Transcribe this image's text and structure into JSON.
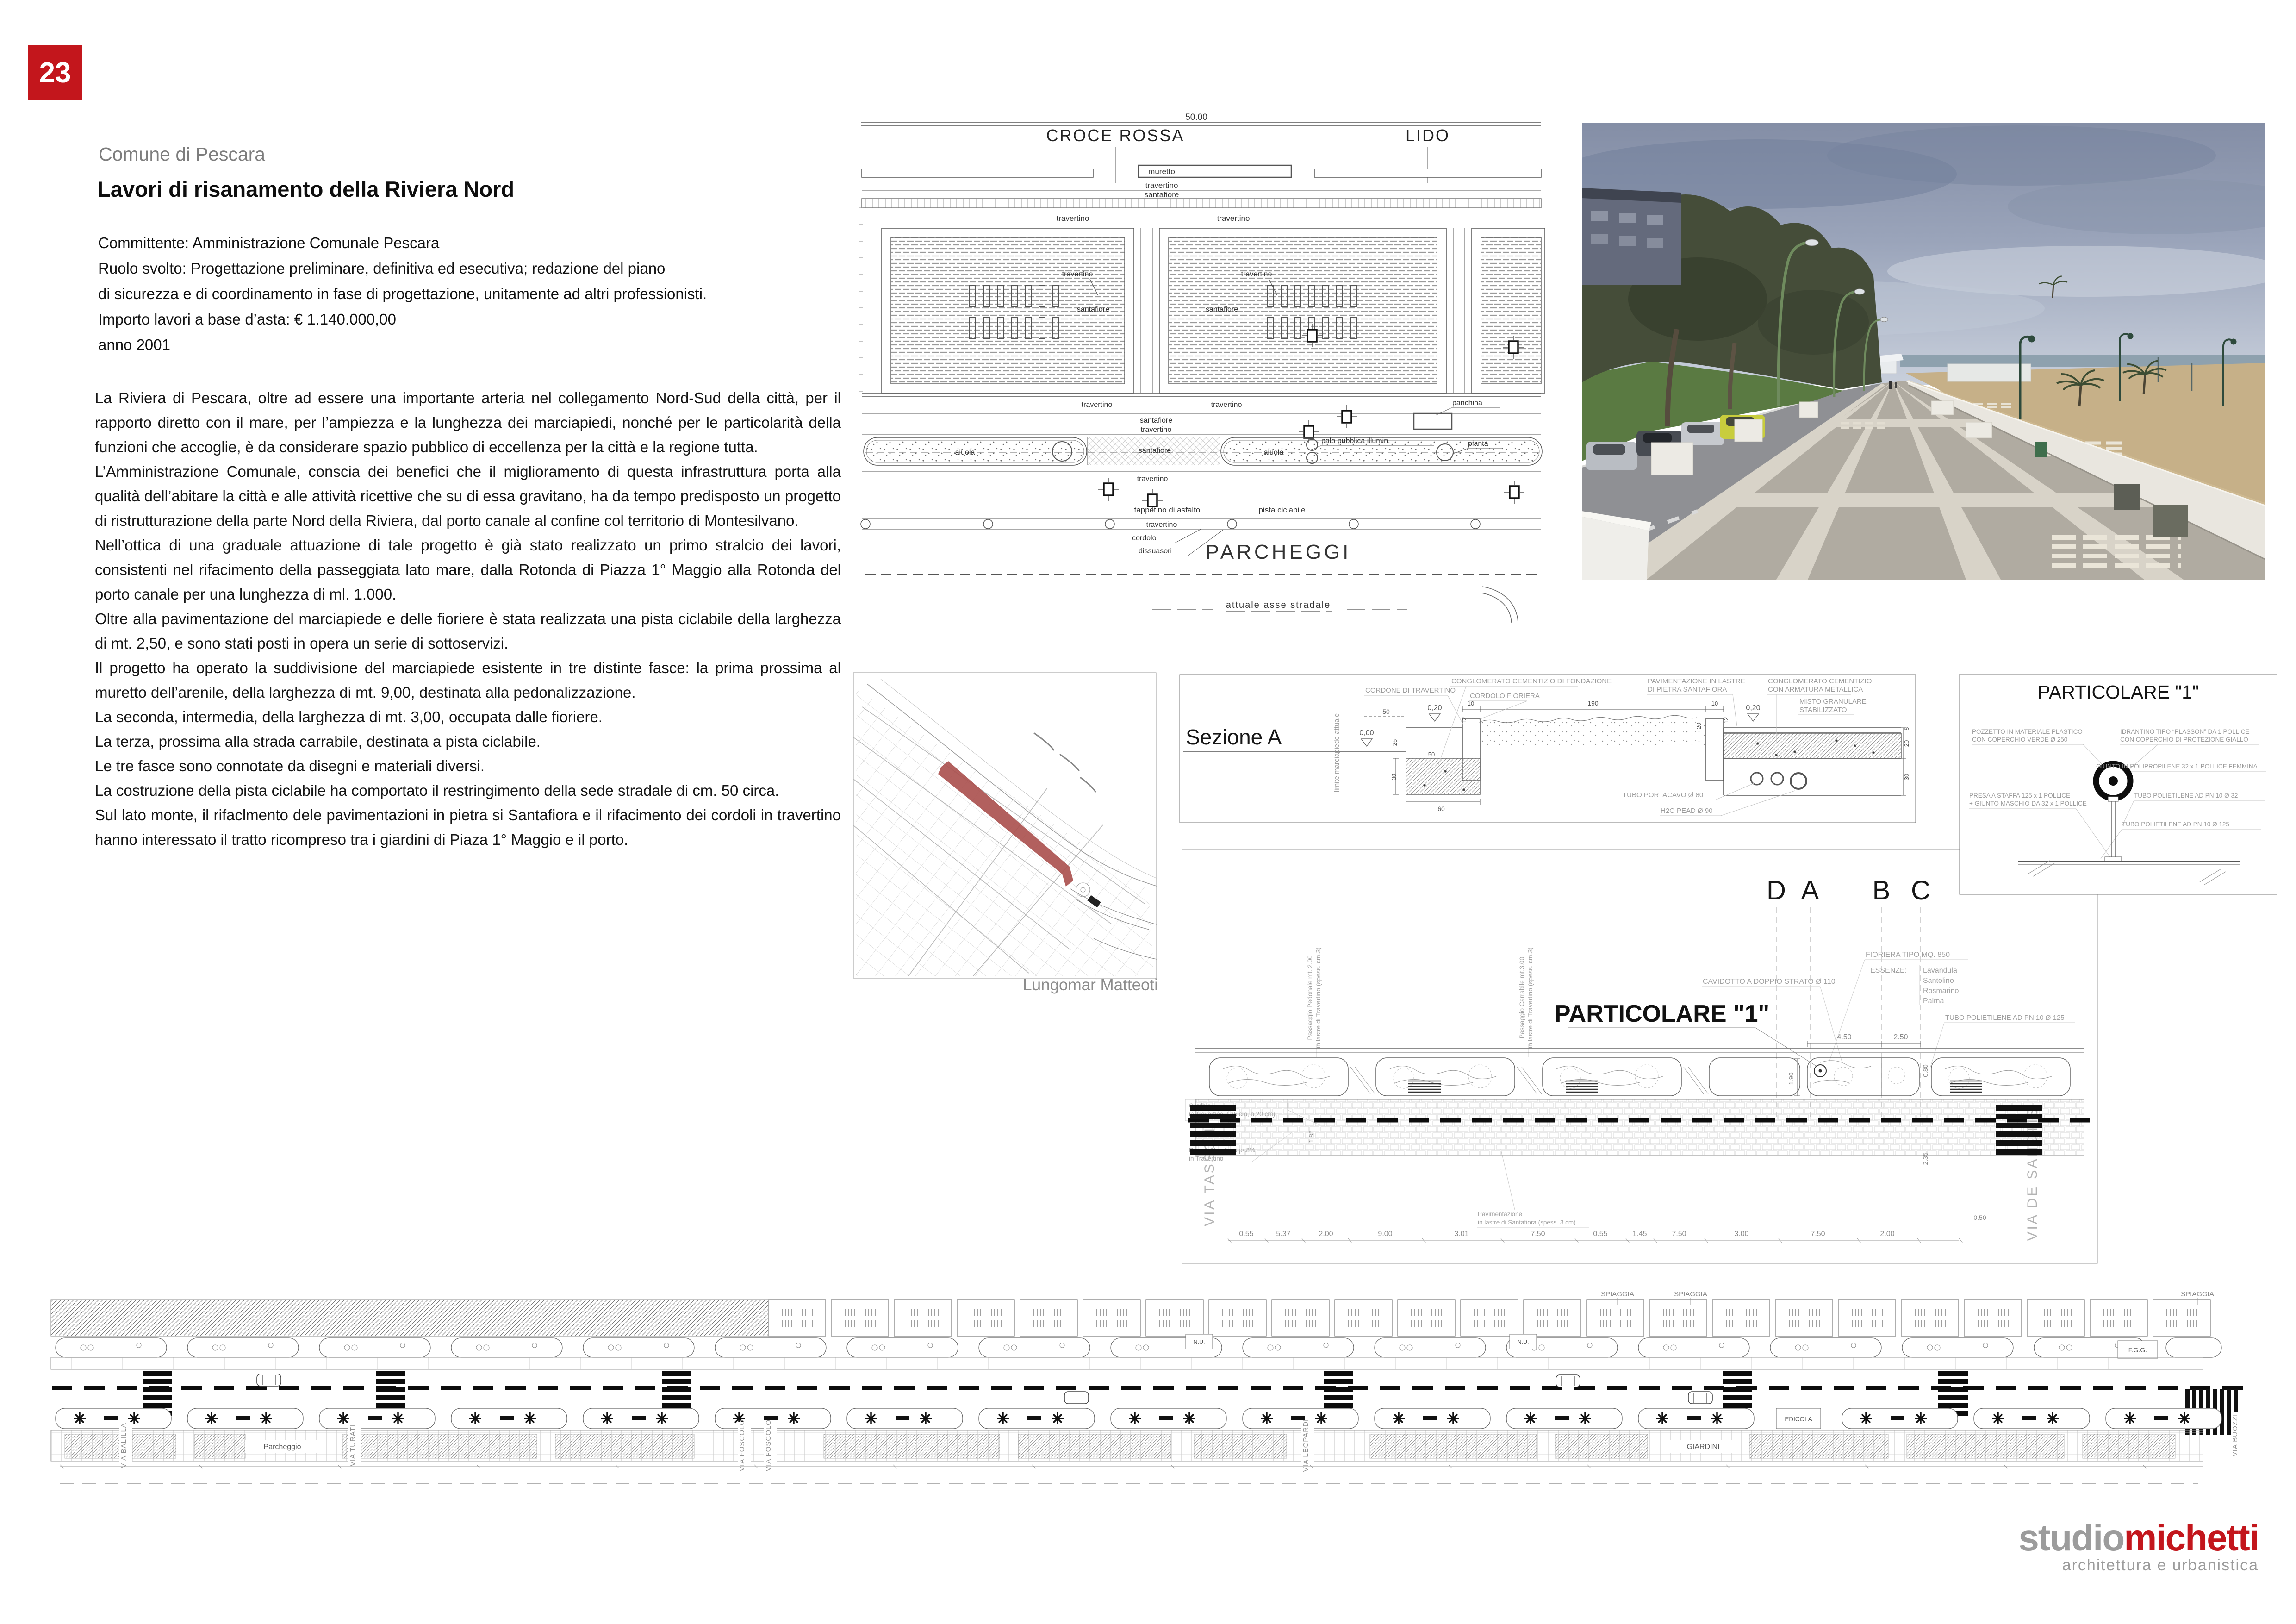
{
  "page_number": "23",
  "header": {
    "pretitle": "Comune di Pescara",
    "title": "Lavori di risanamento della Riviera Nord"
  },
  "details": {
    "line1": "Committente: Amministrazione Comunale Pescara",
    "line2": "Ruolo svolto: Progettazione preliminare, definitiva ed esecutiva; redazione del piano",
    "line3": " di sicurezza e di coordinamento in fase di progettazione, unitamente ad altri professionisti.",
    "line4": "Importo lavori a base d’asta:  € 1.140.000,00",
    "line5": "anno 2001"
  },
  "body": {
    "p1": "La Riviera di Pescara, oltre ad essere una importante arteria nel collegamento Nord-Sud della città, per il rapporto diretto con il mare, per l’ampiezza e la lunghezza dei marciapiedi, nonché per le particolarità della funzioni che accoglie, è da considerare spazio pubblico di eccellenza per la città e la regione tutta.",
    "p2": "L’Amministrazione Comunale, conscia dei benefici che il miglioramento di questa infrastruttura porta alla qualità dell’abitare la città e alle attività ricettive che su di essa gravitano, ha da tempo predisposto un progetto di ristrutturazione della parte Nord della Riviera, dal porto canale al confine col territorio di Montesilvano.",
    "p3": "Nell’ottica di una graduale attuazione di tale progetto è già stato realizzato un primo stralcio dei lavori, consistenti nel rifacimento della passeggiata lato mare, dalla Rotonda di Piazza 1° Maggio alla Rotonda del porto canale per una lunghezza di ml. 1.000.",
    "p4": "Oltre alla pavimentazione del marciapiede e delle fioriere è stata realizzata una pista ciclabile della larghezza di mt. 2,50, e sono stati posti in opera un serie di sottoservizi.",
    "p5": "Il progetto ha operato la suddivisione del marciapiede esistente in tre distinte fasce: la prima prossima al muretto dell’arenile, della larghezza di mt. 9,00, destinata alla pedonalizzazione.",
    "p6": "La seconda, intermedia, della larghezza di mt. 3,00, occupata dalle fioriere.",
    "p7": "La terza, prossima alla strada carrabile, destinata a pista ciclabile.",
    "p8": "Le tre fasce sono connotate da disegni e materiali diversi.",
    "p9": "La costruzione della pista ciclabile ha comportato il restringimento della sede stradale di cm. 50 circa.",
    "p10": "Sul lato monte, il rifaclmento dele pavimentazioni in pietra si Santafiora e il rifacimento dei cordoli in travertino hanno interessato il tratto ricompreso tra i giardini di Piaza 1° Maggio e il porto."
  },
  "plan_top": {
    "dim": "50.00",
    "croce_rossa": "CROCE ROSSA",
    "lido": "LIDO",
    "muretto": "muretto",
    "travertino": "travertino",
    "santafiore": "santafiore",
    "panchina": "panchina",
    "aiuola": "aiuola",
    "palo": "palo pubblica illumin.",
    "pianta": "pianta",
    "tappetino": "tappetino di asfalto",
    "pista": "pista ciclabile",
    "cordolo": "cordolo",
    "dissuasori": "dissuasori",
    "parcheggi": "PARCHEGGI",
    "asse": "attuale asse stradale"
  },
  "map": {
    "caption": "Lungomar Matteoti"
  },
  "sezione": {
    "title": "Sezione A",
    "cordone": "CORDONE DI TRAVERTINO",
    "conglomerato_fond": "CONGLOMERATO CEMENTIZIO DI FONDAZIONE",
    "cordolo_fioriera": "CORDOLO FIORIERA",
    "pav1": "PAVIMENTAZIONE IN LASTRE",
    "pav2": "DI PIETRA SANTAFIORA",
    "cong1": "CONGLOMERATO CEMENTIZIO",
    "cong2": "CON ARMATURA METALLICA",
    "misto1": "MISTO GRANULARE",
    "misto2": "STABILIZZATO",
    "tubo": "TUBO PORTACAVO Ø 80",
    "h2o": "H2O PEAD Ø 90",
    "limite": "limite  marciapiede  attuale",
    "d50": "50",
    "d020": "0,20",
    "d10a": "10",
    "d190": "190",
    "d10b": "10",
    "d000": "0,00",
    "d12": "12",
    "d20": "20",
    "d25": "25",
    "d50b": "50",
    "d30": "30",
    "d60": "60",
    "d5": "5"
  },
  "particolare": {
    "title": "PARTICOLARE \"1\"",
    "pozzetto1": "POZZETTO IN MATERIALE PLASTICO",
    "pozzetto2": "CON COPERCHIO VERDE Ø 250",
    "idrantino1": "IDRANTINO TIPO “PLASSON” DA 1 POLLICE",
    "idrantino2": "CON COPERCHIO DI PROTEZIONE GIALLO",
    "giunto": "GIUNTO IN POLIPROPILENE 32 x 1 POLLICE FEMMINA",
    "presa1": "PRESA A STAFFA 125 x 1 POLLICE",
    "presa2": "+ GIUNTO MASCHIO DA 32 x 1 POLLICE",
    "tubo32": "TUBO POLIETILENE AD PN 10 Ø 32",
    "tubo125": "TUBO POLIETILENE AD PN 10 Ø 125"
  },
  "plan_detail": {
    "letter_d": "D",
    "letter_a": "A",
    "letter_b": "B",
    "letter_c": "C",
    "title": "PARTICOLARE \"1\"",
    "fioriera": "FIORIERA TIPO MQ. 850",
    "essenze": "ESSENZE:",
    "essenza1": "Lavandula",
    "essenza2": "Santolino",
    "essenza3": "Rosmarino",
    "essenza4": "Palma",
    "cavidotto": "CAVIDOTTO A DOPPIO STRATO Ø 110",
    "tubo125": "TUBO POLIETILENE AD PN 10 Ø 125",
    "cordolo1": "Cordolo",
    "cordolo2": "in Travertino (l.35 cm, h.20 cm)",
    "rampa1": "Rampa Handicap p<8%",
    "rampa2": "in Travertino",
    "pedonale1": "Passaggio Pedonale mt. 2.00",
    "pedonale2": "in lastre di Travertino (spess. cm.3)",
    "carrabile1": "Passaggio Carrabile mt.3.00",
    "carrabile2": "in lastre di Travertino (spess. cm.3)",
    "pavimentazione1": "Pavimentazione",
    "pavimentazione2": "in lastre di Santafiora (spess. 3 cm)",
    "via_tassoni": "VIA  TASSONI",
    "via_de_sanctis": "VIA  DE  SANCTIS",
    "dims": [
      "0.55",
      "5.37",
      "2.00",
      "9.00",
      "3.01",
      "7.50",
      "0.55",
      "1.45",
      "7.50",
      "3.00",
      "7.50",
      "2.00"
    ],
    "dim_450": "4.50",
    "dim_250": "2.50",
    "dim_190": "1.90",
    "dim_080": "0.80",
    "dim_235": "2.35",
    "dim_185": "1.85",
    "dim_050": "0.50"
  },
  "strip": {
    "spiaggia": "SPIAGGIA",
    "edicola": "EDICOLA",
    "fgg": "F.G.G.",
    "nu": "N.U.",
    "parcheggio": "Parcheggio",
    "giardini": "GIARDINI",
    "via_balilla": "VIA  BALILLA",
    "via_turati": "VIA  TURATI",
    "via_leopardi": "VIA  LEOPARDI",
    "via_foscolo": "VIA  FOSCOLO",
    "via_buozzi": "VIA  BUOZZI"
  },
  "footer": {
    "logo_gray": "studio",
    "logo_red": "michetti",
    "subtitle": "architettura e urbanistica"
  },
  "colors": {
    "accent_red": "#c3161c",
    "logo_gray": "#9c9c9c",
    "map_highlight": "#aa4f4c"
  }
}
